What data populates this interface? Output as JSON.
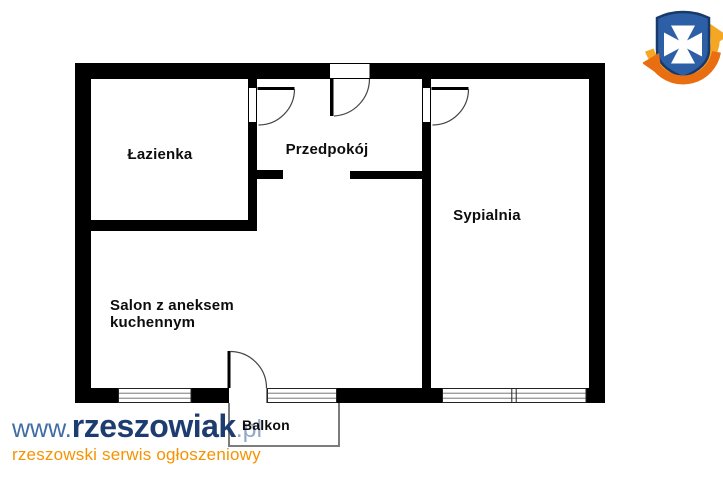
{
  "plan": {
    "type": "apartment-floor-plan",
    "wall_color": "#000000",
    "door_arc_color": "#444444",
    "balcony_outline_color": "#7c7c7c",
    "rooms": {
      "bathroom": {
        "label": "Łazienka"
      },
      "hallway": {
        "label": "Przedpokój"
      },
      "bedroom": {
        "label": "Sypialnia"
      },
      "living_room": {
        "label_line1": "Salon z aneksem",
        "label_line2": "kuchennym"
      },
      "balcony": {
        "label": "Balkon"
      }
    }
  },
  "watermark": {
    "prefix": "www.",
    "brand": "rzeszowiak",
    "suffix": ".pl",
    "tagline": "rzeszowski serwis ogłoszeniowy",
    "colors": {
      "prefix": "#3f6ca3",
      "brand": "#1d3c6f",
      "suffix": "#93a9c9",
      "tagline": "#f59300"
    }
  },
  "logo": {
    "label": "rzeszowiak.pl shield logo",
    "colors": {
      "shield": "#2d5fa6",
      "shield_border": "#173a6b",
      "cross": "#ffffff",
      "arrow_top": "#f5a623",
      "arrow_bottom": "#e96e12"
    }
  }
}
